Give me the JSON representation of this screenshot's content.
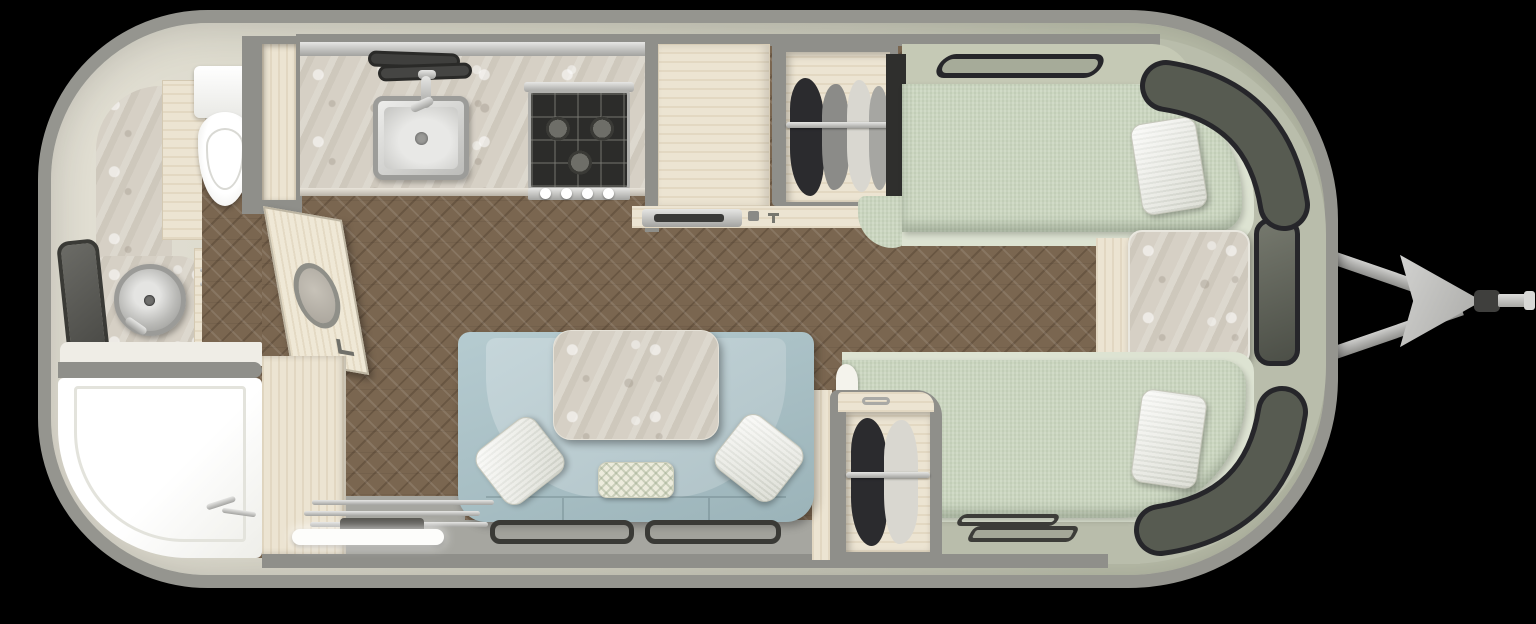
{
  "scene": {
    "title": "Travel trailer floor plan — top-down 3D render, twin-bed layout, hitch at right",
    "view": "top-down",
    "rooms": [
      "rear-bathroom",
      "galley-kitchen",
      "lounge-dinette",
      "wardrobes",
      "front-twin-bedroom"
    ]
  },
  "colors": {
    "page_bg": "#000000",
    "shell_border": "#95958f",
    "wall_cream": "#e3e0d4",
    "wall_mid": "#d2d1c2",
    "wall_green": "#bcc0ac",
    "wall_gray": "#8f8f8a",
    "floor_wood": "#7a6650",
    "deck_green": "#b9bdab",
    "deck_gray": "#a6a6a0",
    "cabinet_cream": "#ece4d2",
    "marble_light": "#d6d0c5",
    "sofa_blue": "#a7c1c7",
    "sofa_seat": "#b9cdd2",
    "bed_sage": "#ccd7c1",
    "bed_platform": "#dde3d2",
    "pillow_white": "#f2f2ec",
    "window_glass": "#575b51",
    "window_frame": "#26262a",
    "metal_silver": "#c9c9c7",
    "metal_dark": "#3f3f3d",
    "white": "#fbfbfa",
    "toilet_white": "#f6f6f3",
    "clothes_dark": "#2b2b2e",
    "clothes_gray": "#8b8b88",
    "clothes_cream": "#d9d7d0",
    "headboard_dark": "#2f2f2d",
    "stove_dark": "#2c2c2a"
  },
  "furniture": [
    {
      "id": "shell",
      "label": "trailer shell with rounded ends"
    },
    {
      "id": "hitch",
      "label": "a-frame hitch tongue with coupler"
    },
    {
      "id": "toilet",
      "label": "toilet"
    },
    {
      "id": "bath-sink",
      "label": "round vessel sink on marble counter"
    },
    {
      "id": "bath-window",
      "label": "bathroom window"
    },
    {
      "id": "shower",
      "label": "wet-bath shower pan"
    },
    {
      "id": "bath-door",
      "label": "open bathroom door with oval window"
    },
    {
      "id": "kitchen-sink",
      "label": "rectangular kitchen sink with faucet"
    },
    {
      "id": "cooktop",
      "label": "gas cooktop with three burners and four knobs"
    },
    {
      "id": "fridge-cabinet",
      "label": "tall cabinet / refrigerator"
    },
    {
      "id": "fridge-vent",
      "label": "appliance vent grille"
    },
    {
      "id": "wardrobe-top",
      "label": "wardrobe with hanging clothes (roadside)"
    },
    {
      "id": "wardrobe-bottom",
      "label": "wardrobe with hanging clothes (curbside)"
    },
    {
      "id": "bed-top",
      "label": "twin bed with pillow (roadside)"
    },
    {
      "id": "bed-bottom",
      "label": "twin bed with pillow (curbside)"
    },
    {
      "id": "nightstand",
      "label": "marble-top nightstand between beds"
    },
    {
      "id": "bed-window",
      "label": "window above roadside bed"
    },
    {
      "id": "front-windows",
      "label": "wraparound front windows"
    },
    {
      "id": "sofa",
      "label": "curved dinette sofa"
    },
    {
      "id": "table",
      "label": "marble dinette table"
    },
    {
      "id": "throw-pillows",
      "label": "throw pillows"
    },
    {
      "id": "entry-step",
      "label": "entry step with grab handle"
    },
    {
      "id": "floor",
      "label": "herringbone wood floor"
    },
    {
      "id": "floor-mats",
      "label": "floor mats at bed foot"
    }
  ]
}
